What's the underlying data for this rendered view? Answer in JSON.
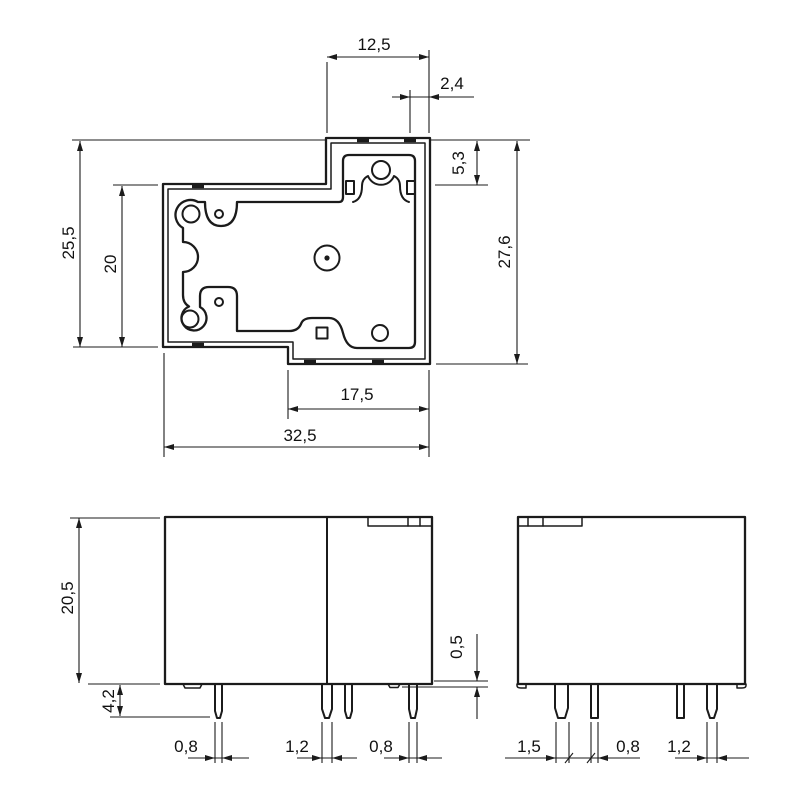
{
  "views": {
    "top": {
      "dims": {
        "top_step_width": "12,5",
        "vent_offset": "2,4",
        "step_height": "5,3",
        "overall_height": "27,6",
        "left_height": "25,5",
        "inner_height": "20",
        "bottom_step_width": "17,5",
        "overall_width": "32,5"
      }
    },
    "front": {
      "dims": {
        "case_height": "20,5",
        "pin_length": "4,2",
        "standoff_height": "0,5",
        "pin1_width": "0,8",
        "pin2_width": "1,2",
        "pin4_width": "0,8"
      }
    },
    "side": {
      "dims": {
        "pin1_width": "1,5",
        "pin2_width": "0,8",
        "pin4_width": "1,2"
      }
    }
  },
  "colors": {
    "line": "#1b1b1b",
    "background": "#ffffff"
  }
}
